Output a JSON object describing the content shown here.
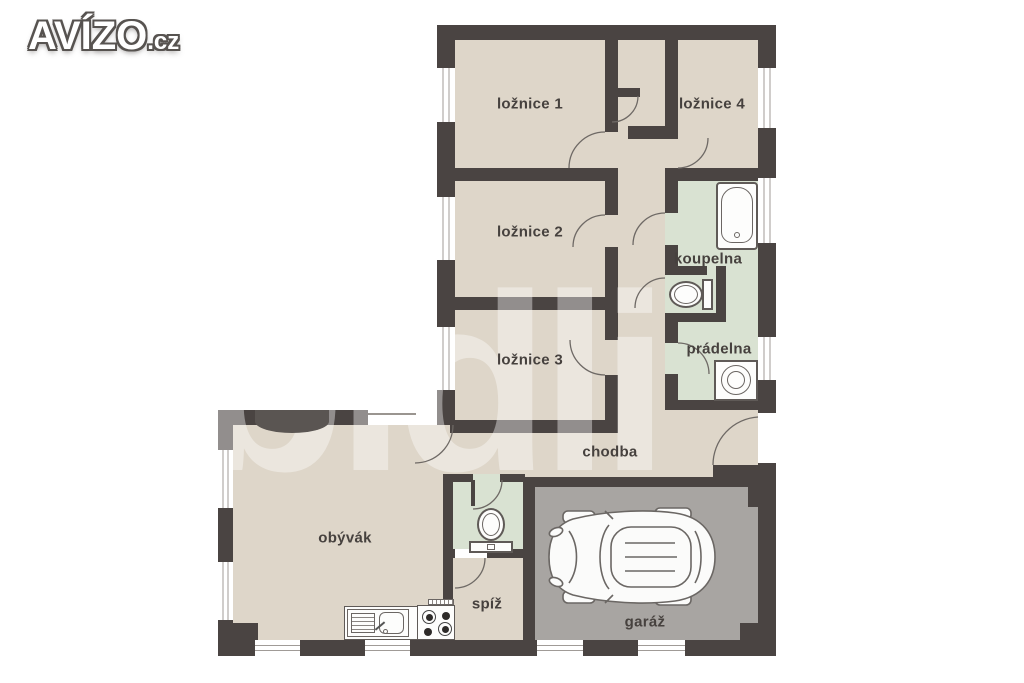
{
  "logo": {
    "brand": "AVÍZO",
    "tld": ".cz"
  },
  "watermark": "bidli",
  "rooms": {
    "loznice1": "ložnice 1",
    "loznice2": "ložnice 2",
    "loznice3": "ložnice 3",
    "loznice4": "ložnice 4",
    "koupelna": "koupelna",
    "pradelna": "prádelna",
    "chodba": "chodba",
    "obyvak": "obývák",
    "spiz": "spíž",
    "garaz": "garáž"
  },
  "colors": {
    "wall": "#4a4442",
    "room_fill": "#ded6c9",
    "wet_room_fill": "#d9e2d2",
    "garage_fill": "#a8a5a2",
    "background": "#ffffff",
    "watermark": "rgba(255,255,255,0.4)"
  },
  "icons": [
    "bathtub-icon",
    "toilet-icon",
    "washing-machine-icon",
    "kitchen-sink-icon",
    "stove-icon",
    "car-icon"
  ]
}
